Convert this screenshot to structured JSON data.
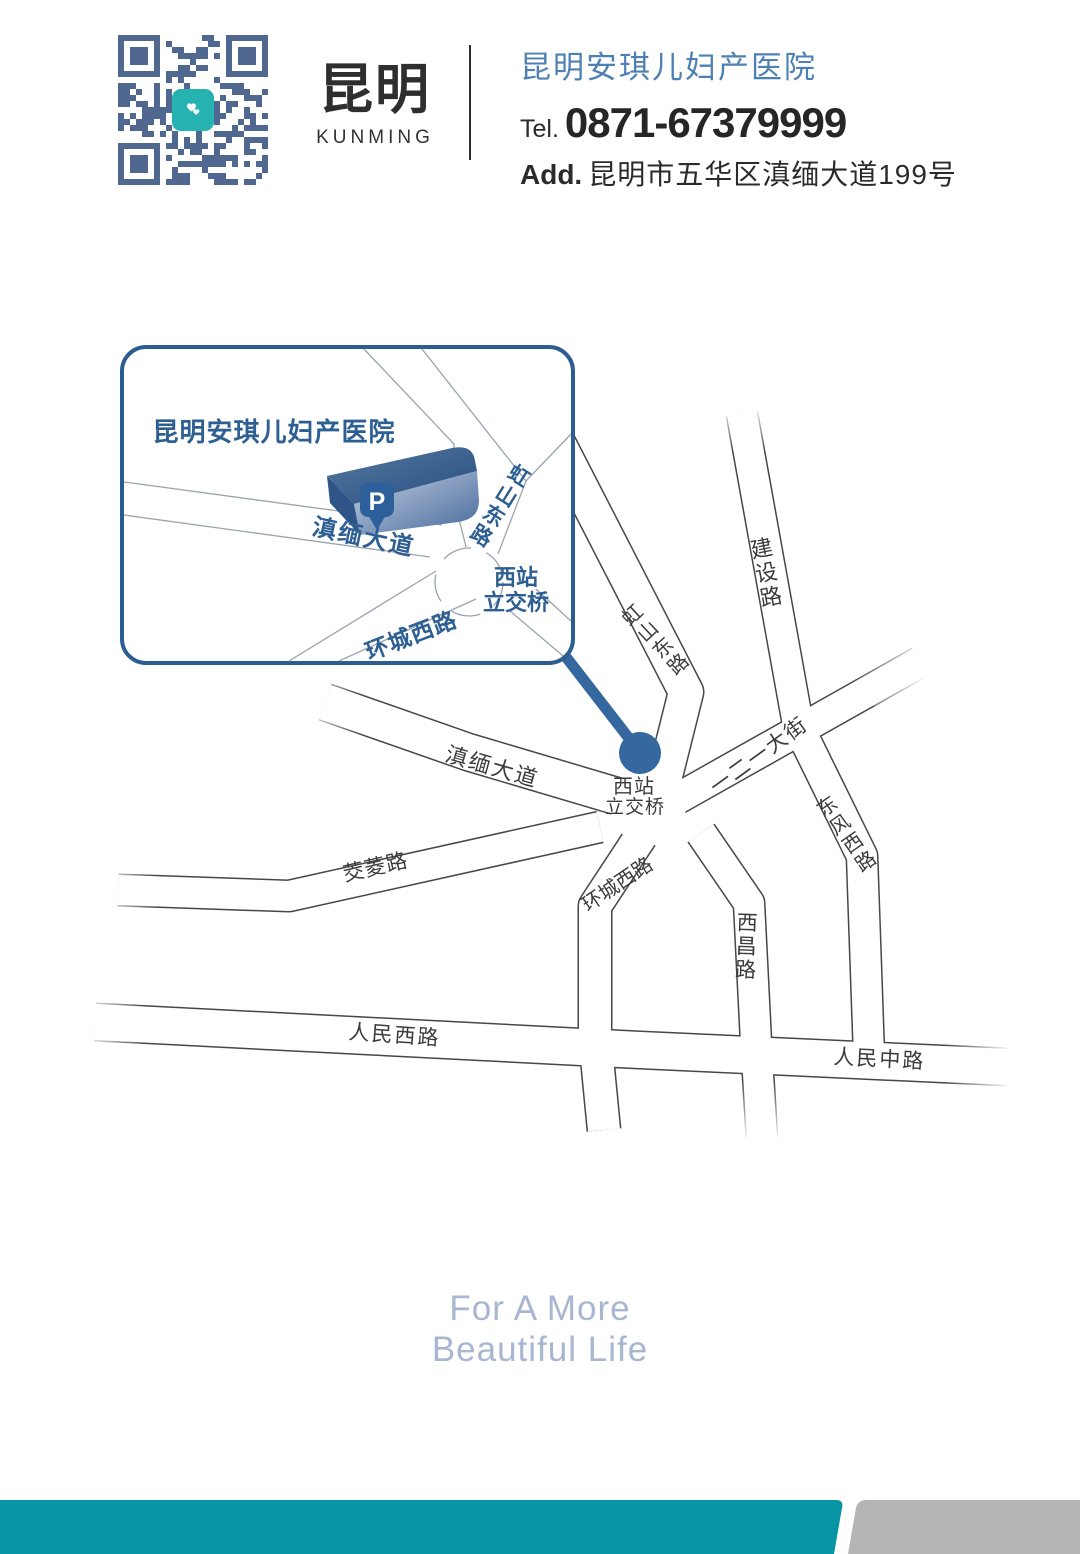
{
  "header": {
    "brand_cn": "昆明",
    "brand_en": "KUNMING",
    "hospital_name": "昆明安琪儿妇产医院",
    "tel_label": "Tel.",
    "tel_number": "0871-67379999",
    "add_label": "Add.",
    "address": "昆明市五华区滇缅大道199号"
  },
  "inset": {
    "title": "昆明安琪儿妇产医院",
    "parking": "P",
    "roads": {
      "dianmian": "滇缅大道",
      "hongshan": "虹山东路",
      "huancheng": "环城西路",
      "interchange1": "西站",
      "interchange2": "立交桥"
    }
  },
  "map": {
    "roads": {
      "dianmian": "滇缅大道",
      "hongshan": "虹山东路",
      "jianshe": "建设路",
      "yieryi": "一二一大街",
      "dongfeng": "东风西路",
      "xichang": "西昌路",
      "huancheng": "环城西路",
      "jiaoling": "茭菱路",
      "renminxi": "人民西路",
      "renminzhong": "人民中路",
      "interchange1": "西站",
      "interchange2": "立交桥"
    }
  },
  "footer": {
    "line1": "For A More",
    "line2": "Beautiful Life"
  },
  "colors": {
    "brand_blue": "#4e80b3",
    "map_blue": "#2d5f92",
    "marker_blue": "#35689f",
    "road_line": "#474747",
    "teal_bar": "#0795a3",
    "gray_bar": "#b5b5b5",
    "qr_module": "#50688f",
    "qr_logo_teal": "#25b2b0",
    "footer_blue": "#a9b6d2"
  }
}
